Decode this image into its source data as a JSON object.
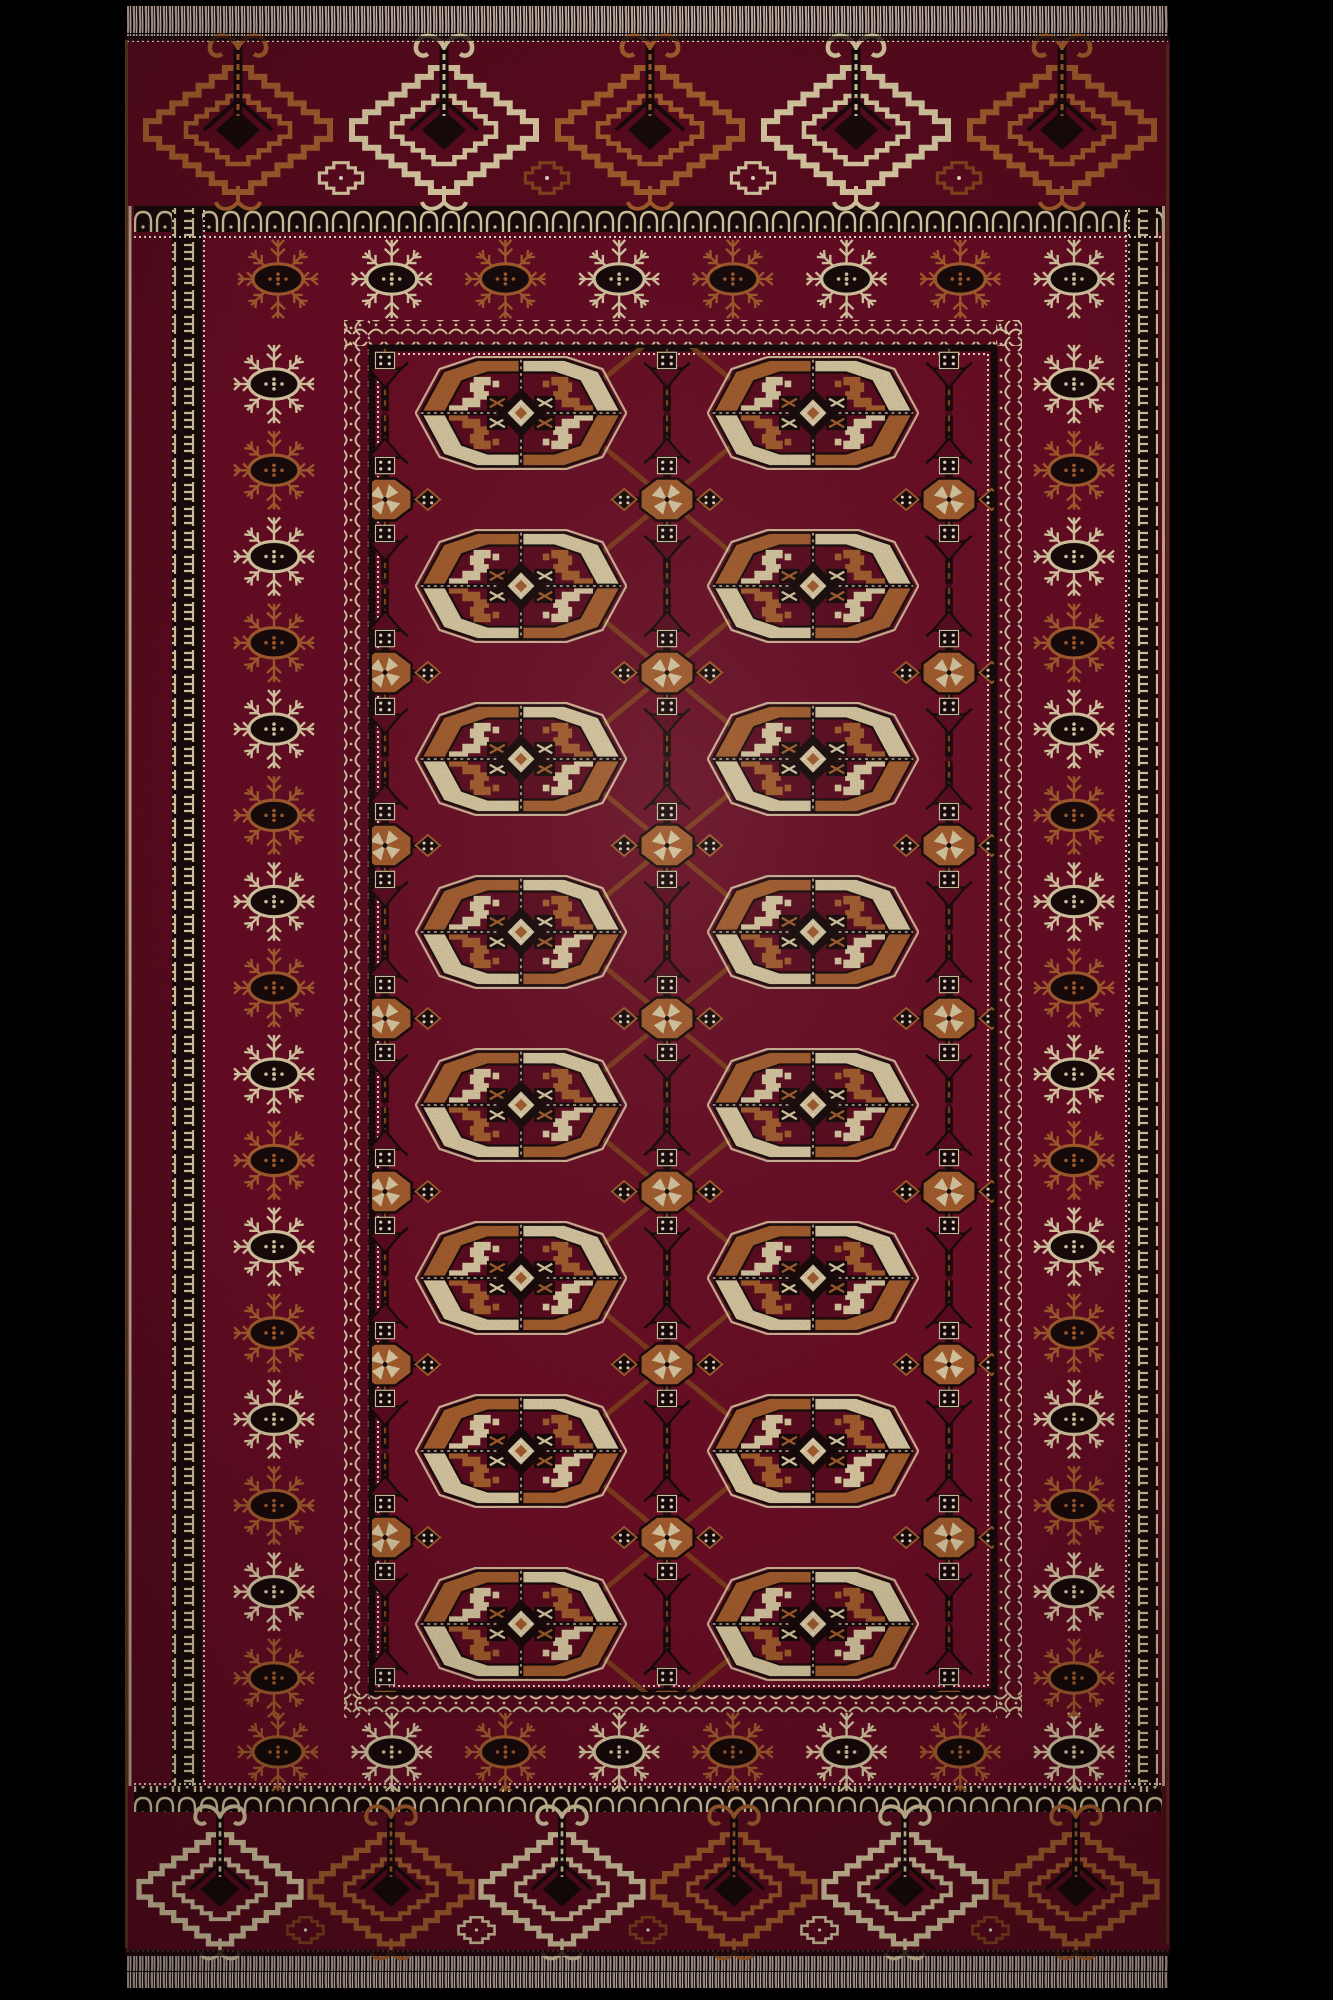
{
  "scene": {
    "type": "photograph",
    "subject": "Hand-knotted Turkmen Tekke (Bokhara) wool rug photographed flat on a black background",
    "background_color": "#000000"
  },
  "palette": {
    "field": "#741029",
    "band": "#6e0e27",
    "elem": "#600d21",
    "gulred": "#630d22",
    "copper": "#b26532",
    "copperdeep": "#8e4a20",
    "cream": "#ebd9b0",
    "dot": "#f6edda",
    "ink": "#1a0c0c",
    "fringe": "#d8b4a8",
    "fringelight": "#efe3d8",
    "olive": "#6e6824"
  },
  "rug": {
    "fringe": {
      "position": "top and bottom",
      "style": "short pink-beige knotted fringe"
    },
    "elem_bands": {
      "motif": "kejebe arrow medallion with spiral bird-head crest",
      "top_motifs": [
        "copper",
        "cream",
        "copper",
        "cream",
        "copper"
      ],
      "bottom_motifs": [
        "cream",
        "copper",
        "cream",
        "copper",
        "cream",
        "copper"
      ]
    },
    "border": {
      "guards": [
        "comb guard",
        "arcade guard",
        "bead line",
        "diamond lattice guard"
      ],
      "snowflake_ring": {
        "motif": "eight-ray sprig rosette (gochak) with oval center",
        "top_count": 8,
        "bottom_count": 8,
        "side_count": 16,
        "color_sequence": "alternating cream and copper"
      }
    },
    "field": {
      "gul": {
        "motif": "quartered Tekke gul octagon",
        "rows": 8,
        "columns": 2
      },
      "chemche": {
        "motif": "cross-shaped chemche with whirl star",
        "rows": 9,
        "columns": 3
      }
    }
  }
}
